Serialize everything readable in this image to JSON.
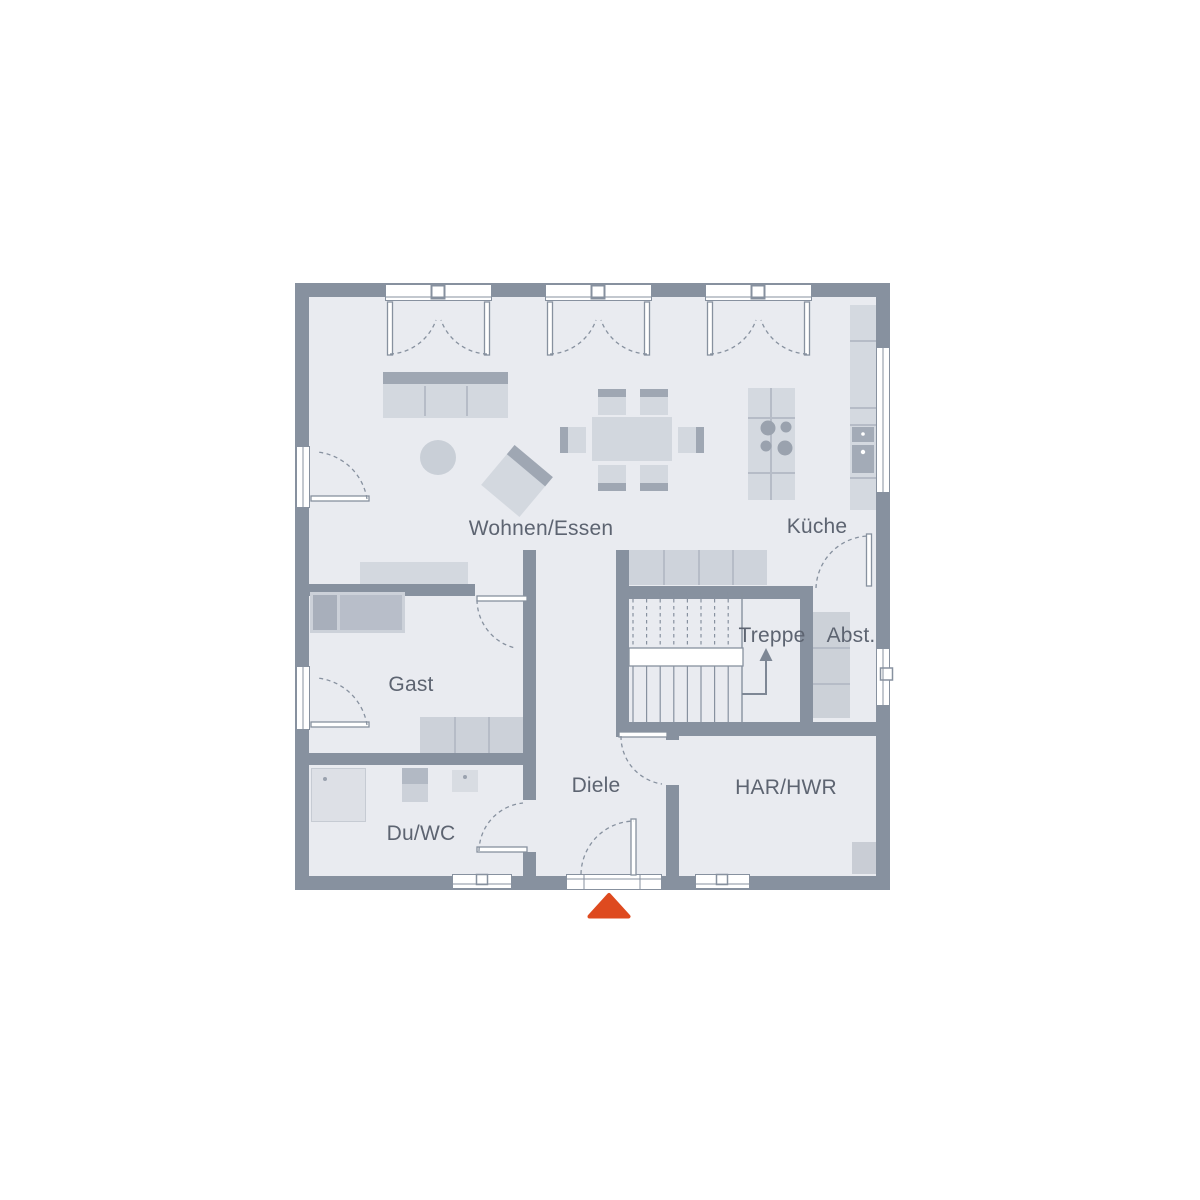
{
  "plan_type": "floor-plan",
  "rooms": [
    {
      "id": "wohnen-essen",
      "label": "Wohnen/Essen"
    },
    {
      "id": "kueche",
      "label": "Küche"
    },
    {
      "id": "gast",
      "label": "Gast"
    },
    {
      "id": "treppe",
      "label": "Treppe"
    },
    {
      "id": "abstellraum",
      "label": "Abst."
    },
    {
      "id": "diele",
      "label": "Diele"
    },
    {
      "id": "dusche-wc",
      "label": "Du/WC"
    },
    {
      "id": "har-hwr",
      "label": "HAR/HWR"
    }
  ],
  "stairs": {
    "label": "Treppe",
    "direction": "up"
  },
  "entrance_marker": {
    "shape": "triangle-up",
    "color": "#de4a1f"
  },
  "colors": {
    "wall": "#87919f",
    "floor": "#e9ebf0",
    "furniture_light": "#d3d8df",
    "furniture_dark": "#9fa7b3",
    "label_text": "#5d6471",
    "entrance_accent": "#de4a1f"
  }
}
